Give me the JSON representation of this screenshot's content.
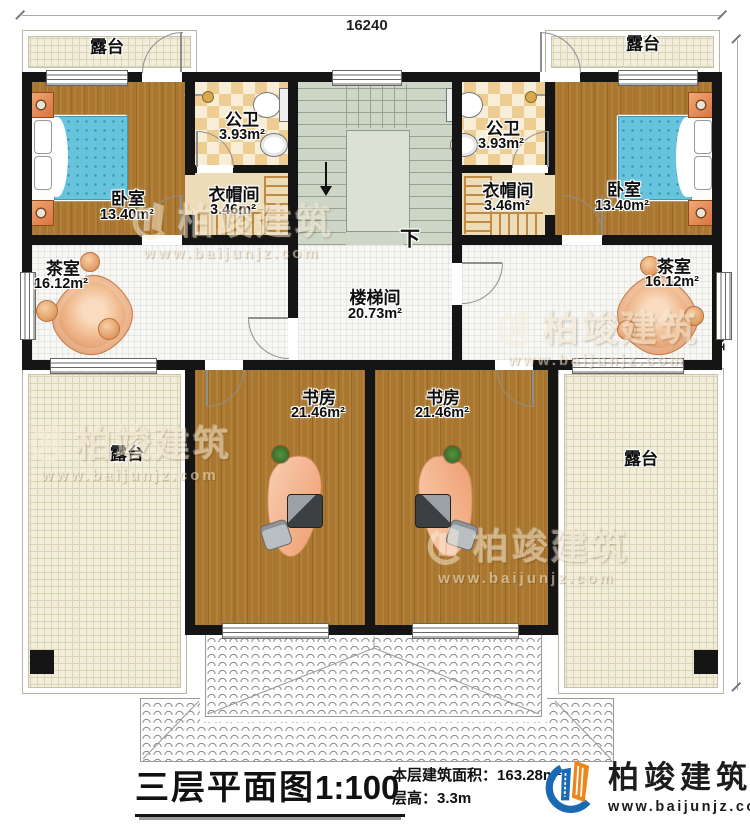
{
  "dimensions": {
    "top": "16240",
    "right": "16020"
  },
  "rooms": {
    "terrace_tl": {
      "name": "露台"
    },
    "terrace_tr": {
      "name": "露台"
    },
    "bedroom_l": {
      "name": "卧室",
      "area": "13.40m²"
    },
    "bathroom_l": {
      "name": "公卫",
      "area": "3.93m²"
    },
    "cloakroom_l": {
      "name": "衣帽间",
      "area": "3.46m²"
    },
    "bathroom_r": {
      "name": "公卫",
      "area": "3.93m²"
    },
    "cloakroom_r": {
      "name": "衣帽间",
      "area": "3.46m²"
    },
    "bedroom_r": {
      "name": "卧室",
      "area": "13.40m²"
    },
    "tearoom_l": {
      "name": "茶室",
      "area": "16.12m²"
    },
    "tearoom_r": {
      "name": "茶室",
      "area": "16.12m²"
    },
    "stairwell": {
      "name": "楼梯间",
      "area": "20.73m²",
      "down": "下"
    },
    "study_l": {
      "name": "书房",
      "area": "21.46m²"
    },
    "study_r": {
      "name": "书房",
      "area": "21.46m²"
    },
    "terrace_bl": {
      "name": "露台"
    },
    "terrace_br": {
      "name": "露台"
    }
  },
  "title_block": {
    "title": "三层平面图",
    "scale": "1:100",
    "area_label": "本层建筑面积：",
    "area_value": "163.28m²",
    "height_label": "层高：",
    "height_value": "3.3m"
  },
  "branding": {
    "company": "柏竣建筑",
    "website": "www.baijunjz.com"
  },
  "colors": {
    "wall": "#151515",
    "wood": "#a9772f",
    "stair_green": "#cdd6c7",
    "checker_tan": "#eecd92",
    "terrace_beige": "#f1edda",
    "logo_blue": "#1a6ab3",
    "logo_orange": "#f08519",
    "bed_blue": "#67c4dc",
    "lounge_orange": "#e8a06e"
  }
}
